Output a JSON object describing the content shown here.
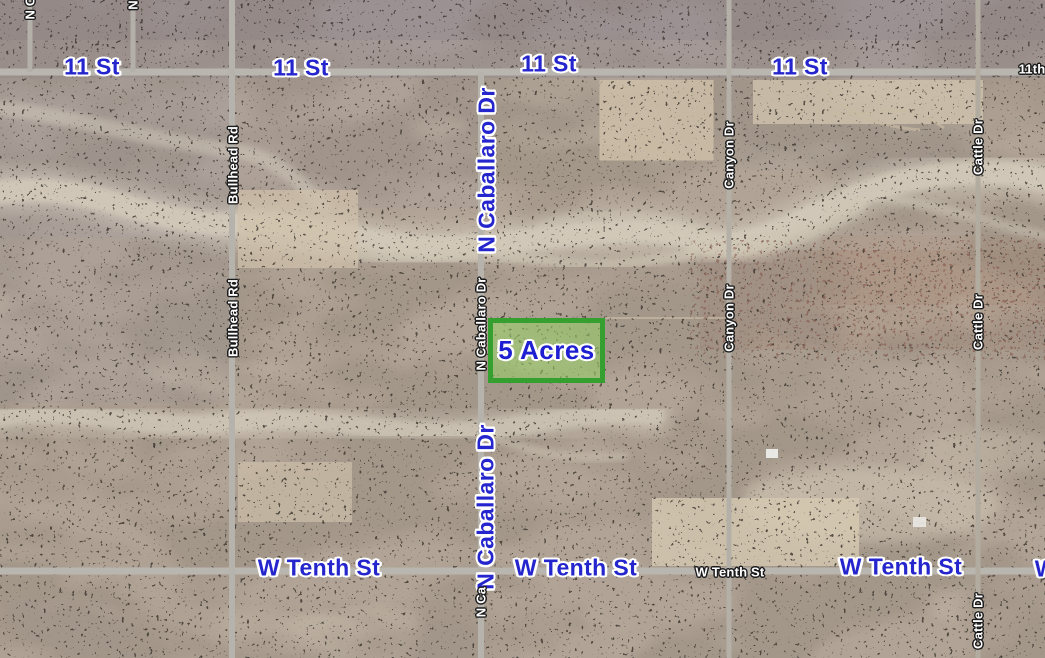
{
  "map": {
    "type": "satellite-map",
    "parcel": {
      "label": "5 Acres",
      "border_color": "#35a02f",
      "fill_color": "rgba(152,210,102,0.55)",
      "label_color": "#1f1fd2"
    },
    "label_colors": {
      "major_fill": "#2525cd",
      "major_outline": "#ffffff",
      "minor_fill": "#ffffff",
      "minor_outline": "#1b1b1b"
    },
    "labels": [
      {
        "text": "11 St",
        "x": 92,
        "y": 67,
        "o": "h",
        "style": "major"
      },
      {
        "text": "11 St",
        "x": 301,
        "y": 68,
        "o": "h",
        "style": "major"
      },
      {
        "text": "11 St",
        "x": 549,
        "y": 64,
        "o": "h",
        "style": "major"
      },
      {
        "text": "11 St",
        "x": 800,
        "y": 67,
        "o": "h",
        "style": "major"
      },
      {
        "text": "N Caballaro Dr",
        "x": 487,
        "y": 170,
        "o": "v",
        "style": "major"
      },
      {
        "text": "N Caballaro Dr",
        "x": 486,
        "y": 507,
        "o": "v",
        "style": "major"
      },
      {
        "text": "W Tenth St",
        "x": 319,
        "y": 568,
        "o": "h",
        "style": "major"
      },
      {
        "text": "W Tenth St",
        "x": 576,
        "y": 568,
        "o": "h",
        "style": "major"
      },
      {
        "text": "W Tenth St",
        "x": 901,
        "y": 567,
        "o": "h",
        "style": "major"
      },
      {
        "text": "W Tenth St",
        "x": 1096,
        "y": 569,
        "o": "h",
        "style": "major"
      },
      {
        "text": "Bullhead Rd",
        "x": 233,
        "y": 165,
        "o": "v",
        "style": "minor"
      },
      {
        "text": "Bullhead Rd",
        "x": 233,
        "y": 318,
        "o": "v",
        "style": "minor"
      },
      {
        "text": "N Caballaro Dr",
        "x": 481,
        "y": 324,
        "o": "v",
        "style": "minor"
      },
      {
        "text": "N Ca",
        "x": 481,
        "y": 602,
        "o": "v",
        "style": "minor"
      },
      {
        "text": "Canyon Dr",
        "x": 729,
        "y": 155,
        "o": "v",
        "style": "minor"
      },
      {
        "text": "Canyon Dr",
        "x": 729,
        "y": 318,
        "o": "v",
        "style": "minor"
      },
      {
        "text": "Cattle Dr",
        "x": 978,
        "y": 147,
        "o": "v",
        "style": "minor"
      },
      {
        "text": "Cattle Dr",
        "x": 978,
        "y": 322,
        "o": "v",
        "style": "minor"
      },
      {
        "text": "Cattle Dr",
        "x": 978,
        "y": 621,
        "o": "v",
        "style": "minor"
      },
      {
        "text": "W Tenth St",
        "x": 730,
        "y": 572,
        "o": "h",
        "style": "minor"
      },
      {
        "text": "11th",
        "x": 1032,
        "y": 69,
        "o": "h",
        "style": "minor"
      },
      {
        "text": "N C",
        "x": 30,
        "y": 8,
        "o": "v",
        "style": "minor"
      },
      {
        "text": "N",
        "x": 133,
        "y": 5,
        "o": "v",
        "style": "minor"
      }
    ],
    "terrain_colors": {
      "base_tan": "#b1a496",
      "top_mauve": "#8f8793",
      "wash_light": "#d6cdbd",
      "road_gray": "#b6b3ac",
      "red_brown_zone": "#9a6f5c"
    }
  }
}
